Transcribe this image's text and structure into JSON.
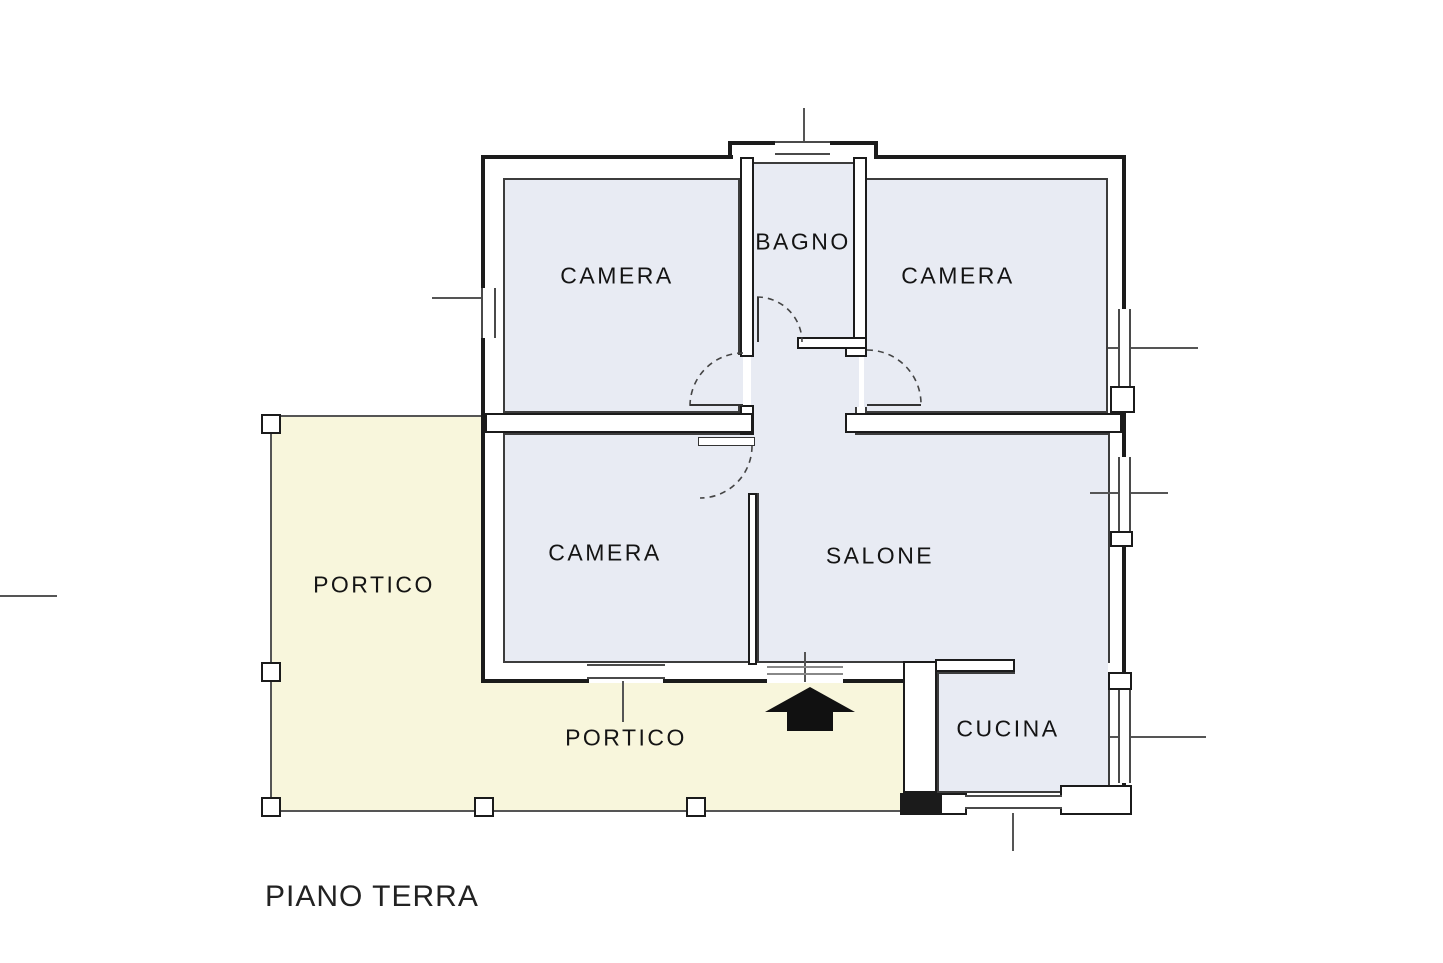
{
  "title": "PIANO TERRA",
  "colors": {
    "background": "#ffffff",
    "portico_fill": "#f8f6dc",
    "room_fill": "#e8ebf3",
    "wall": "#1b1b1b",
    "thin_line": "#555555",
    "text": "#141414"
  },
  "labels": [
    {
      "id": "room-label-camera-top-left",
      "text": "CAMERA",
      "x": 617,
      "y": 276,
      "size": 23
    },
    {
      "id": "room-label-bagno",
      "text": "BAGNO",
      "x": 803,
      "y": 242,
      "size": 23
    },
    {
      "id": "room-label-camera-top-right",
      "text": "CAMERA",
      "x": 958,
      "y": 276,
      "size": 23
    },
    {
      "id": "room-label-camera-bottom",
      "text": "CAMERA",
      "x": 605,
      "y": 553,
      "size": 23
    },
    {
      "id": "room-label-salone",
      "text": "SALONE",
      "x": 880,
      "y": 556,
      "size": 23
    },
    {
      "id": "room-label-cucina",
      "text": "CUCINA",
      "x": 1008,
      "y": 729,
      "size": 23
    },
    {
      "id": "room-label-portico-left",
      "text": "PORTICO",
      "x": 374,
      "y": 585,
      "size": 23
    },
    {
      "id": "room-label-portico-bottom",
      "text": "PORTICO",
      "x": 626,
      "y": 738,
      "size": 23
    }
  ],
  "title_pos": {
    "x": 265,
    "y": 880,
    "size": 30
  },
  "plan": {
    "width": 1443,
    "height": 963,
    "column_size": 20,
    "cream_areas": [
      {
        "x": 272,
        "y": 416,
        "w": 211,
        "h": 395
      },
      {
        "x": 483,
        "y": 683,
        "w": 420,
        "h": 128
      }
    ],
    "rooms": [
      {
        "x": 503,
        "y": 178,
        "w": 237,
        "h": 235
      },
      {
        "x": 752,
        "y": 162,
        "w": 105,
        "h": 177
      },
      {
        "x": 865,
        "y": 178,
        "w": 243,
        "h": 235
      },
      {
        "x": 503,
        "y": 433,
        "w": 247,
        "h": 230
      },
      {
        "x": 757,
        "y": 433,
        "w": 353,
        "h": 230
      },
      {
        "x": 752,
        "y": 345,
        "w": 105,
        "h": 90
      },
      {
        "x": 937,
        "y": 672,
        "w": 173,
        "h": 121
      }
    ],
    "patches": [
      {
        "x": 754,
        "y": 420,
        "w": 101,
        "h": 24
      },
      {
        "x": 752,
        "y": 335,
        "w": 47,
        "h": 14
      },
      {
        "x": 746,
        "y": 433,
        "w": 15,
        "h": 60
      },
      {
        "x": 1015,
        "y": 655,
        "w": 93,
        "h": 25
      },
      {
        "x": 736,
        "y": 355,
        "w": 7,
        "h": 50
      },
      {
        "x": 864,
        "y": 355,
        "w": 8,
        "h": 52
      },
      {
        "x": 853,
        "y": 357,
        "w": 6,
        "h": 50
      },
      {
        "x": 751,
        "y": 357,
        "w": 5,
        "h": 48
      }
    ],
    "walls": [
      {
        "x": 481,
        "y": 155,
        "w": 252,
        "h": 4,
        "solid": true
      },
      {
        "x": 728,
        "y": 141,
        "w": 150,
        "h": 4,
        "solid": true
      },
      {
        "x": 728,
        "y": 141,
        "w": 4,
        "h": 18,
        "solid": true
      },
      {
        "x": 874,
        "y": 141,
        "w": 4,
        "h": 18,
        "solid": true
      },
      {
        "x": 874,
        "y": 155,
        "w": 252,
        "h": 4,
        "solid": true
      },
      {
        "x": 481,
        "y": 155,
        "w": 4,
        "h": 135,
        "solid": true
      },
      {
        "x": 481,
        "y": 336,
        "w": 4,
        "h": 347,
        "solid": true
      },
      {
        "x": 1122,
        "y": 155,
        "w": 4,
        "h": 154,
        "solid": true
      },
      {
        "x": 1122,
        "y": 386,
        "w": 4,
        "h": 71,
        "solid": true
      },
      {
        "x": 1122,
        "y": 531,
        "w": 4,
        "h": 159,
        "solid": true
      },
      {
        "x": 1122,
        "y": 783,
        "w": 4,
        "h": 30,
        "solid": true
      },
      {
        "x": 481,
        "y": 679,
        "w": 108,
        "h": 4,
        "solid": true
      },
      {
        "x": 663,
        "y": 679,
        "w": 104,
        "h": 4,
        "solid": true
      },
      {
        "x": 843,
        "y": 679,
        "w": 62,
        "h": 4,
        "solid": true
      },
      {
        "x": 900,
        "y": 793,
        "w": 42,
        "h": 22,
        "solid": true
      },
      {
        "x": 740,
        "y": 157,
        "w": 14,
        "h": 200
      },
      {
        "x": 740,
        "y": 405,
        "w": 14,
        "h": 30
      },
      {
        "x": 853,
        "y": 157,
        "w": 14,
        "h": 185
      },
      {
        "x": 845,
        "y": 339,
        "w": 22,
        "h": 18
      },
      {
        "x": 797,
        "y": 337,
        "w": 70,
        "h": 12
      },
      {
        "x": 485,
        "y": 413,
        "w": 268,
        "h": 20
      },
      {
        "x": 845,
        "y": 413,
        "w": 277,
        "h": 20
      },
      {
        "x": 748,
        "y": 493,
        "w": 9,
        "h": 172
      },
      {
        "x": 903,
        "y": 661,
        "w": 34,
        "h": 132
      },
      {
        "x": 935,
        "y": 659,
        "w": 80,
        "h": 13
      },
      {
        "x": 1110,
        "y": 386,
        "w": 25,
        "h": 27
      },
      {
        "x": 1110,
        "y": 531,
        "w": 23,
        "h": 16
      },
      {
        "x": 1108,
        "y": 672,
        "w": 24,
        "h": 18
      },
      {
        "x": 940,
        "y": 793,
        "w": 27,
        "h": 22
      },
      {
        "x": 1060,
        "y": 785,
        "w": 72,
        "h": 30
      },
      {
        "x": 698,
        "y": 437,
        "w": 57,
        "h": 9,
        "leaf": true
      }
    ],
    "windows": [
      {
        "x": 481,
        "y": 288,
        "w": 15,
        "h": 50,
        "o": "v"
      },
      {
        "x": 775,
        "y": 141,
        "w": 55,
        "h": 14,
        "o": "h"
      },
      {
        "x": 1118,
        "y": 309,
        "w": 13,
        "h": 77,
        "o": "v"
      },
      {
        "x": 1118,
        "y": 457,
        "w": 13,
        "h": 74,
        "o": "v"
      },
      {
        "x": 1118,
        "y": 690,
        "w": 13,
        "h": 93,
        "o": "v"
      },
      {
        "x": 587,
        "y": 664,
        "w": 78,
        "h": 15,
        "o": "h"
      },
      {
        "x": 965,
        "y": 795,
        "w": 97,
        "h": 14,
        "o": "h"
      }
    ],
    "lines": [
      {
        "x": 268,
        "y": 415,
        "w": 215,
        "h": 2
      },
      {
        "x": 270,
        "y": 415,
        "w": 2,
        "h": 397
      },
      {
        "x": 268,
        "y": 810,
        "w": 637,
        "h": 2
      },
      {
        "x": 432,
        "y": 297,
        "w": 50,
        "h": 2
      },
      {
        "x": 1108,
        "y": 347,
        "w": 90,
        "h": 2
      },
      {
        "x": 1090,
        "y": 492,
        "w": 78,
        "h": 2
      },
      {
        "x": 1110,
        "y": 736,
        "w": 96,
        "h": 2
      },
      {
        "x": 1012,
        "y": 813,
        "w": 2,
        "h": 38
      },
      {
        "x": 803,
        "y": 108,
        "w": 2,
        "h": 34
      },
      {
        "x": 622,
        "y": 681,
        "w": 2,
        "h": 41
      },
      {
        "x": 804,
        "y": 652,
        "w": 2,
        "h": 30
      },
      {
        "x": 0,
        "y": 595,
        "w": 57,
        "h": 2
      },
      {
        "x": 767,
        "y": 666,
        "w": 76,
        "h": 2,
        "c": "#888"
      },
      {
        "x": 767,
        "y": 673,
        "w": 76,
        "h": 2,
        "c": "#888"
      }
    ],
    "columns": [
      {
        "x": 261,
        "y": 414
      },
      {
        "x": 261,
        "y": 662
      },
      {
        "x": 261,
        "y": 797
      },
      {
        "x": 474,
        "y": 797
      },
      {
        "x": 686,
        "y": 797
      }
    ],
    "door_arcs": [
      {
        "d": "M 757,297 A 45 45 0 0 1 802,342"
      },
      {
        "d": "M 743,353 A 53 53 0 0 0 690,406"
      },
      {
        "d": "M 867,350 A 54 54 0 0 1 921,404"
      },
      {
        "d": "M 752,446 A 52 52 0 0 1 700,498"
      }
    ],
    "door_leaves": [
      {
        "x1": 758,
        "y1": 297,
        "x2": 758,
        "y2": 342
      },
      {
        "x1": 690,
        "y1": 405,
        "x2": 743,
        "y2": 405
      },
      {
        "x1": 867,
        "y1": 405,
        "x2": 921,
        "y2": 405
      }
    ],
    "entrance_arrow": {
      "points": "810,687 855,712 833,712 833,731 787,731 787,712 765,712",
      "color": "#111111"
    }
  }
}
